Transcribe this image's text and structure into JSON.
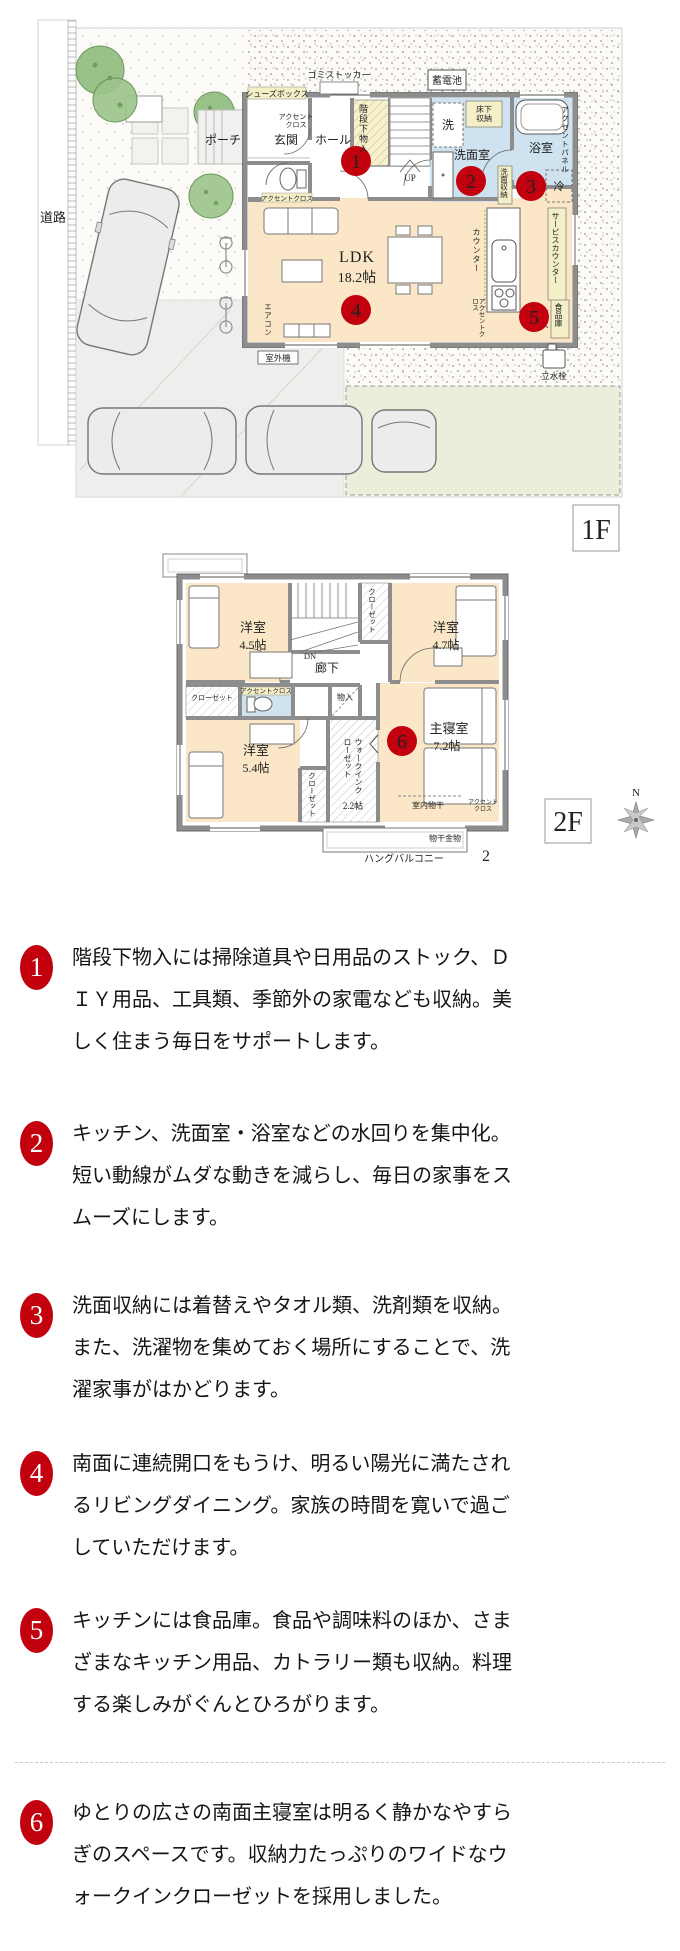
{
  "badge_color": "#c2000e",
  "f1": {
    "tag": "1F",
    "road": "道路",
    "gomi": "ゴミストッカー",
    "battery": "蓄電池",
    "shoes": "シューズボックス",
    "accent_a1": "アクセント",
    "accent_a2": "クロス",
    "porch": "ポーチ",
    "entrance": "玄関",
    "hall": "ホール",
    "under_stair": "階段下物入",
    "up": "UP",
    "washer": "洗",
    "underfloor1": "床下",
    "underfloor2": "収納",
    "washroom": "洗面室",
    "bath": "浴室",
    "accent_panel": "アクセントパネル",
    "wash_storage": "洗面収納",
    "fridge": "冷",
    "ldk": "LDK",
    "ldk_size": "18.2帖",
    "counter": "カウンター",
    "service_counter": "サービスカウンター",
    "pantry": "食品庫",
    "accent_toilet": "アクセントクロス",
    "accent_kitchen": "アクセントクロス",
    "aircon": "エアコン",
    "outdoor": "室外機",
    "tap": "立水栓"
  },
  "f2": {
    "tag": "2F",
    "north": "N",
    "room1": "洋室",
    "room1_size": "4.5帖",
    "room2": "洋室",
    "room2_size": "4.7帖",
    "room3": "洋室",
    "room3_size": "5.4帖",
    "master": "主寝室",
    "master_size": "7.2帖",
    "corridor": "廊下",
    "dn": "DN",
    "closet_top": "クローゼット",
    "closet_mid": "クローゼット",
    "closet_btm": "クローゼット",
    "wic": "ウォークインクローゼット",
    "wic_size": "2.2帖",
    "storage": "物入",
    "accent_toilet": "アクセントクロス",
    "indoor_dry": "室内物干",
    "accent_m1": "アクセント",
    "accent_m2": "クロス",
    "dry_hw": "物干金物",
    "balcony": "ハングバルコニー",
    "two": "2"
  },
  "badges": {
    "b1": "1",
    "b2": "2",
    "b3": "3",
    "b4": "4",
    "b5": "5",
    "b6": "6"
  },
  "sections": [
    {
      "num": "1",
      "text": "階段下物入には掃除道具や日用品のストック、ＤＩＹ用品、工具類、季節外の家電なども収納。美しく住まう毎日をサポートします。"
    },
    {
      "num": "2",
      "text": "キッチン、洗面室・浴室などの水回りを集中化。短い動線がムダな動きを減らし、毎日の家事をスムーズにします。"
    },
    {
      "num": "3",
      "text": "洗面収納には着替えやタオル類、洗剤類を収納。また、洗濯物を集めておく場所にすることで、洗濯家事がはかどります。"
    },
    {
      "num": "4",
      "text": "南面に連続開口をもうけ、明るい陽光に満たされるリビングダイニング。家族の時間を寛いで過ごしていただけます。"
    },
    {
      "num": "5",
      "text": "キッチンには食品庫。食品や調味料のほか、さまざまなキッチン用品、カトラリー類も収納。料理する楽しみがぐんとひろがります。"
    },
    {
      "num": "6",
      "text": "ゆとりの広さの南面主寝室は明るく静かなやすらぎのスペースです。収納力たっぷりのワイドなウォークインクローゼットを採用しました。"
    }
  ]
}
